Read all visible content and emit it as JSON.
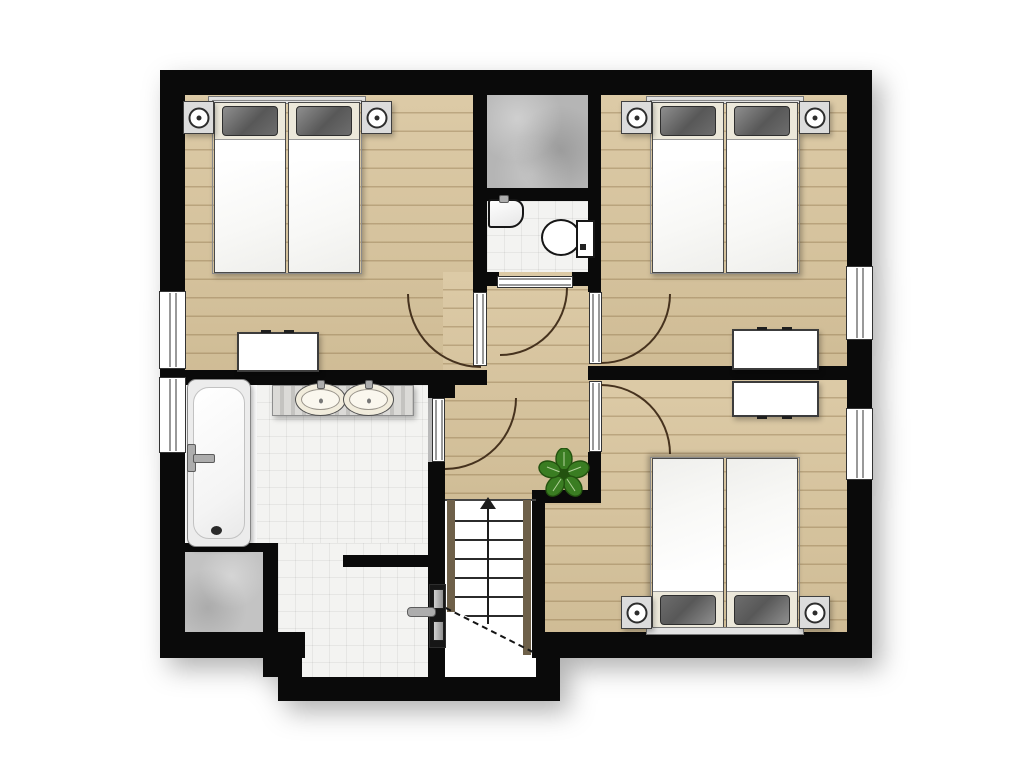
{
  "page": {
    "background": "#ffffff",
    "description": "Architectural 2D floor plan of an upper storey, no text labels rendered"
  },
  "plan": {
    "rooms": [
      {
        "id": "bedroom-1",
        "position": "top-left",
        "floor": "wood-plank",
        "furniture": [
          "double-bed",
          "two-dark-pillows",
          "nightstand-with-lamp-left",
          "nightstand-with-lamp-right",
          "white-dresser"
        ]
      },
      {
        "id": "storage-closet",
        "position": "top-center",
        "floor": "gray-concrete"
      },
      {
        "id": "wc",
        "position": "center-top",
        "floor": "white-tile",
        "fixtures": [
          "corner-hand-basin",
          "toilet-with-cistern"
        ]
      },
      {
        "id": "bedroom-2",
        "position": "top-right",
        "floor": "wood-plank",
        "furniture": [
          "double-bed",
          "two-dark-pillows",
          "nightstand-with-lamp-left",
          "nightstand-with-lamp-right",
          "white-dresser"
        ]
      },
      {
        "id": "hallway",
        "position": "center",
        "floor": "wood-plank",
        "decor": [
          "potted-plant"
        ]
      },
      {
        "id": "bathroom",
        "position": "left-middle",
        "floor": "white-tile",
        "fixtures": [
          "bathtub-with-faucet",
          "double-washbasin-counter",
          "gray-shaft-square",
          "door-with-lever-handle"
        ]
      },
      {
        "id": "bedroom-3",
        "position": "bottom-right",
        "floor": "wood-plank",
        "furniture": [
          "double-bed",
          "two-dark-pillows",
          "nightstand-with-lamp-left",
          "nightstand-with-lamp-right",
          "white-dresser"
        ]
      },
      {
        "id": "staircase",
        "position": "bottom-center",
        "details": [
          "up-direction-arrow",
          "dashed-cut-line",
          "wood-stringers"
        ]
      }
    ],
    "openings": {
      "windows": 4,
      "window_positions": [
        "left-wall-bedroom-1",
        "left-wall-bathroom",
        "right-wall-bedroom-2",
        "right-wall-bedroom-3"
      ],
      "hinged_doors": 5,
      "door_positions": [
        "bedroom-1",
        "wc",
        "bedroom-2",
        "bedroom-3",
        "bathroom"
      ],
      "closed_door_with_handle": 1
    },
    "colors": {
      "wall": "#0a0a0a",
      "wood": "#d8c49c",
      "tile": "#f3f3f1",
      "plainfloor": "#fafafa",
      "graycloset": "#b5b5b5",
      "graysq": "#c3c3c3",
      "arc": "#46321e",
      "cream": "#ece8da",
      "pillowdark": "#585858",
      "pillowlight": "#8f8f8f",
      "duvet": "#f8f8f6",
      "sheet": "#ffffff",
      "framegray": "#8a8a8a",
      "stand": "#dcdcdc",
      "standring": "#2d2d2d",
      "counter": "#cfcdca",
      "sinkfill": "#f1ecdc",
      "stringer": "#6e6049",
      "dash": "#141414",
      "doorleaf": "#161616",
      "metal": "#adadad",
      "tubfill": "#ececec",
      "windowline": "#333333",
      "plantgreen": "#3a7d22",
      "plantdark": "#23520f"
    }
  }
}
